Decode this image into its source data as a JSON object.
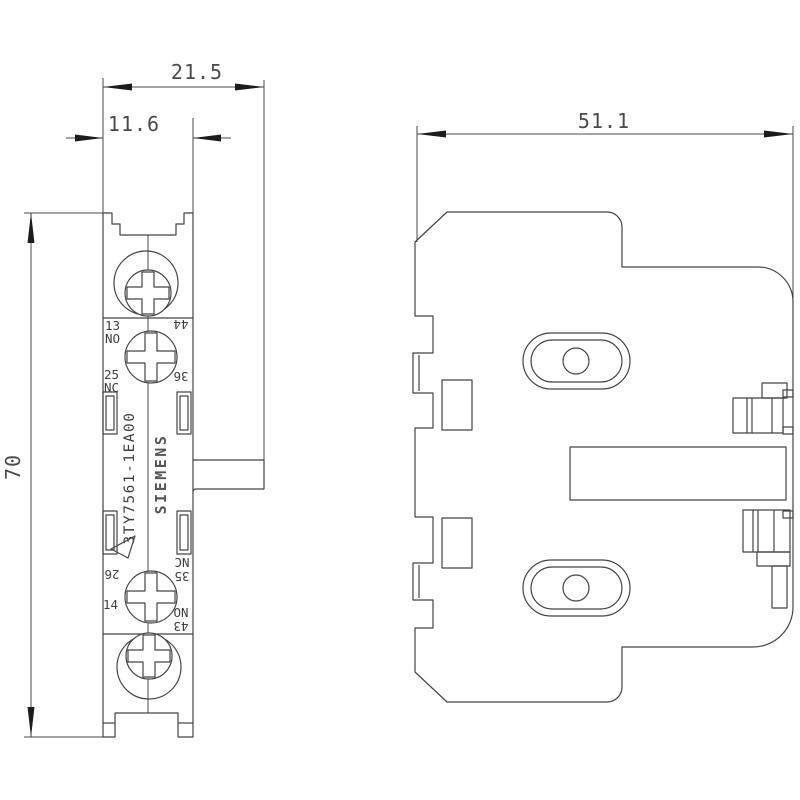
{
  "drawing": {
    "background": "#ffffff",
    "line_color": "#444444",
    "text_color": "#4a4a4a",
    "dimensions": {
      "overall_width_mm": "21.5",
      "body_width_mm": "11.6",
      "depth_mm": "51.1",
      "height_mm": "70"
    },
    "side_view": {
      "part_number": "3TY7561-1EA00",
      "brand": "SIEMENS",
      "terminal_labels": {
        "top_left_num": "13",
        "top_left_type": "NO",
        "top_right_num": "44",
        "upper_left_num": "25",
        "upper_left_type": "NC",
        "upper_right_num": "36",
        "lower_left_num": "26",
        "lower_right_type": "NC",
        "lower_right_num": "35",
        "bottom_left_num": "14",
        "bottom_right_type": "NO",
        "bottom_right_num": "43"
      }
    }
  }
}
